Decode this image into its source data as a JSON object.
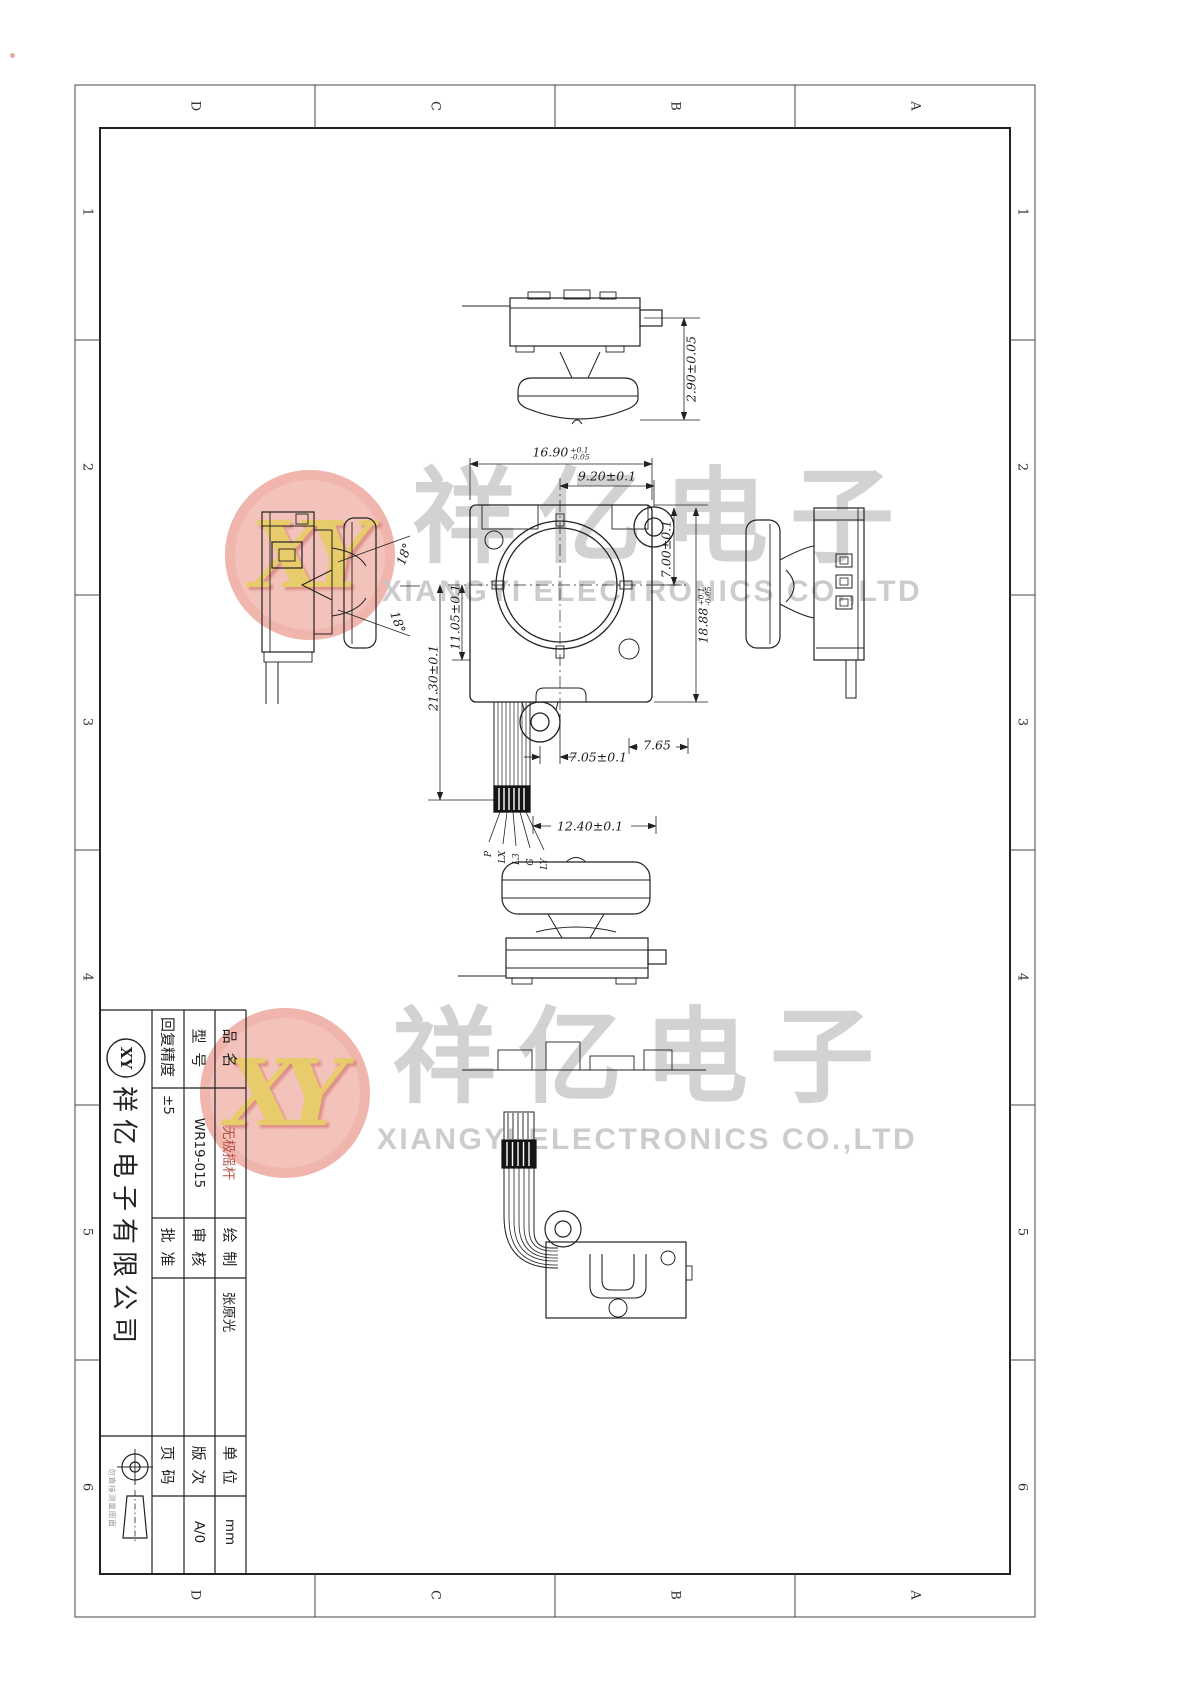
{
  "frame": {
    "zone_letters_top": [
      "D",
      "C",
      "B",
      "A"
    ],
    "zone_letters_bottom": [
      "D",
      "C",
      "B",
      "A"
    ],
    "zone_numbers_left": [
      "1",
      "2",
      "3",
      "4",
      "5",
      "6"
    ],
    "zone_numbers_right": [
      "1",
      "2",
      "3",
      "4",
      "5",
      "6"
    ]
  },
  "watermark": {
    "logo_text": "XY",
    "cn": [
      "祥",
      "亿",
      "电",
      "子"
    ],
    "en_text": "XIANGYI ELECTRONICS CO.,LTD",
    "logo_color": "#f3beb6",
    "logo_letter_color": "#e7c860",
    "gray": "#cbcbcb"
  },
  "dims": {
    "d_290": "2.90±0.05",
    "d_1690_main": "16.90",
    "d_1690_up": "+0.1",
    "d_1690_dn": "-0.05",
    "d_920": "9.20±0.1",
    "d_700": "7.00±0.1",
    "d_1888_main": "18.88",
    "d_1888_up": "+0.1",
    "d_1888_dn": "-0.05",
    "d_1105": "11.05±0.1",
    "d_2130": "21.30±0.1",
    "d_705": "7.05±0.1",
    "d_765": "7.65",
    "d_1240": "12.40±0.1",
    "angle_upper": "18°",
    "angle_lower": "18°",
    "pins": [
      "P",
      "LX",
      "L3",
      "G",
      "LY"
    ]
  },
  "title_block": {
    "product_label": "品 名",
    "product_value": "无极摇杆",
    "model_label": "型 号",
    "model_value": "WR19-015",
    "precision_label": "回复精度",
    "precision_value": "±5",
    "draw_label": "绘 制",
    "draw_value": "张原光",
    "check_label": "审 核",
    "check_value": "",
    "approve_label": "批 准",
    "approve_value": "",
    "unit_label": "单 位",
    "unit_value": "mm",
    "rev_label": "版 次",
    "rev_value": "A/0",
    "page_label": "页 码",
    "page_value": "",
    "company": "祥亿电子有限公司",
    "logo": "XY",
    "note": "勿直接测量图面"
  }
}
